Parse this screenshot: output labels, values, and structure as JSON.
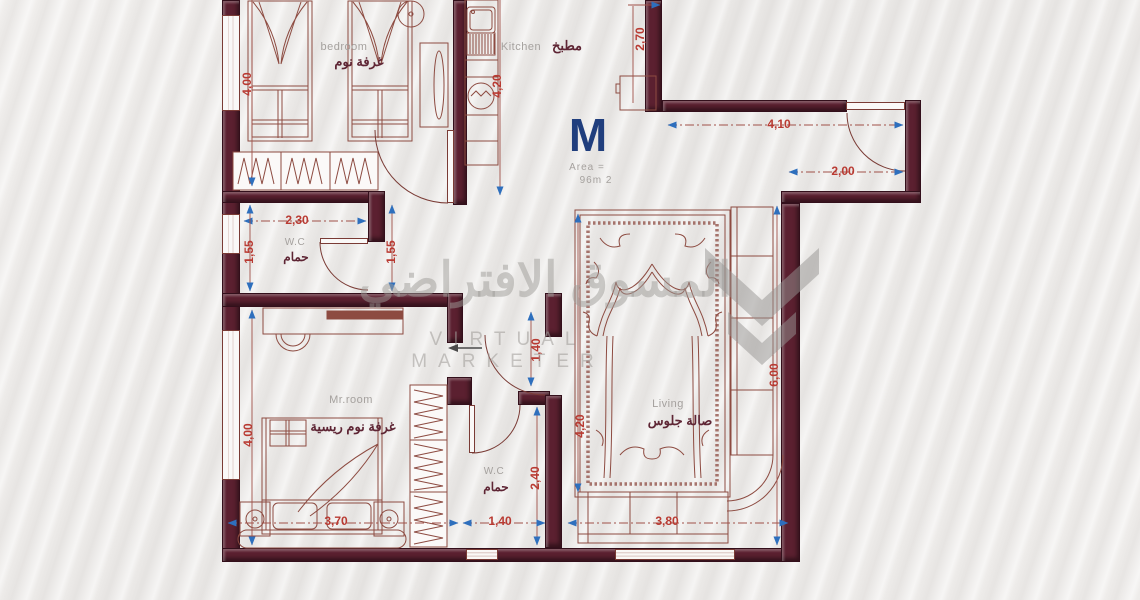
{
  "plan_info": {
    "letter": "M",
    "area_label": "Area  =",
    "area_value": "96m 2"
  },
  "rooms": {
    "bedroom": {
      "en": "bedroom",
      "ar": "غرفة نوم"
    },
    "kitchen": {
      "en": "Kitchen",
      "ar": "مطبخ"
    },
    "wc1": {
      "en": "W.C",
      "ar": "حمام"
    },
    "master": {
      "en": "Mr.room",
      "ar": "غرفة نوم ريسية"
    },
    "wc2": {
      "en": "W.C",
      "ar": "حمام"
    },
    "living": {
      "en": "Living",
      "ar": "صالة جلوس"
    }
  },
  "dims": {
    "bedroom_left": "4,00",
    "kitchen_counter": "4,20",
    "kitchen_entry": "2,70",
    "entry_top": "4,10",
    "entry_door": "2,00",
    "wc1_width": "2,30",
    "wc1_left": "1,55",
    "wc1_right": "1,55",
    "hall": "1,40",
    "rug_left": "4,20",
    "living_right": "6,00",
    "living_bottom": "3,80",
    "master_left": "4,00",
    "master_bottom": "3,70",
    "wc2_right": "2,40",
    "wc2_bottom": "1,40"
  },
  "watermark": {
    "arabic": "المسوق الافتراضي",
    "latin": "VIRTUAL MARKETER"
  },
  "colors": {
    "wall": "#5b2030",
    "furniture_line": "#8d4b41",
    "dim_text": "#b93a32",
    "dim_arrow": "#2e6fbd",
    "label_gray": "#a5a19e",
    "label_arabic": "#5e2534",
    "title_navy": "#203e7d",
    "watermark_gray": "#9e9b98"
  }
}
